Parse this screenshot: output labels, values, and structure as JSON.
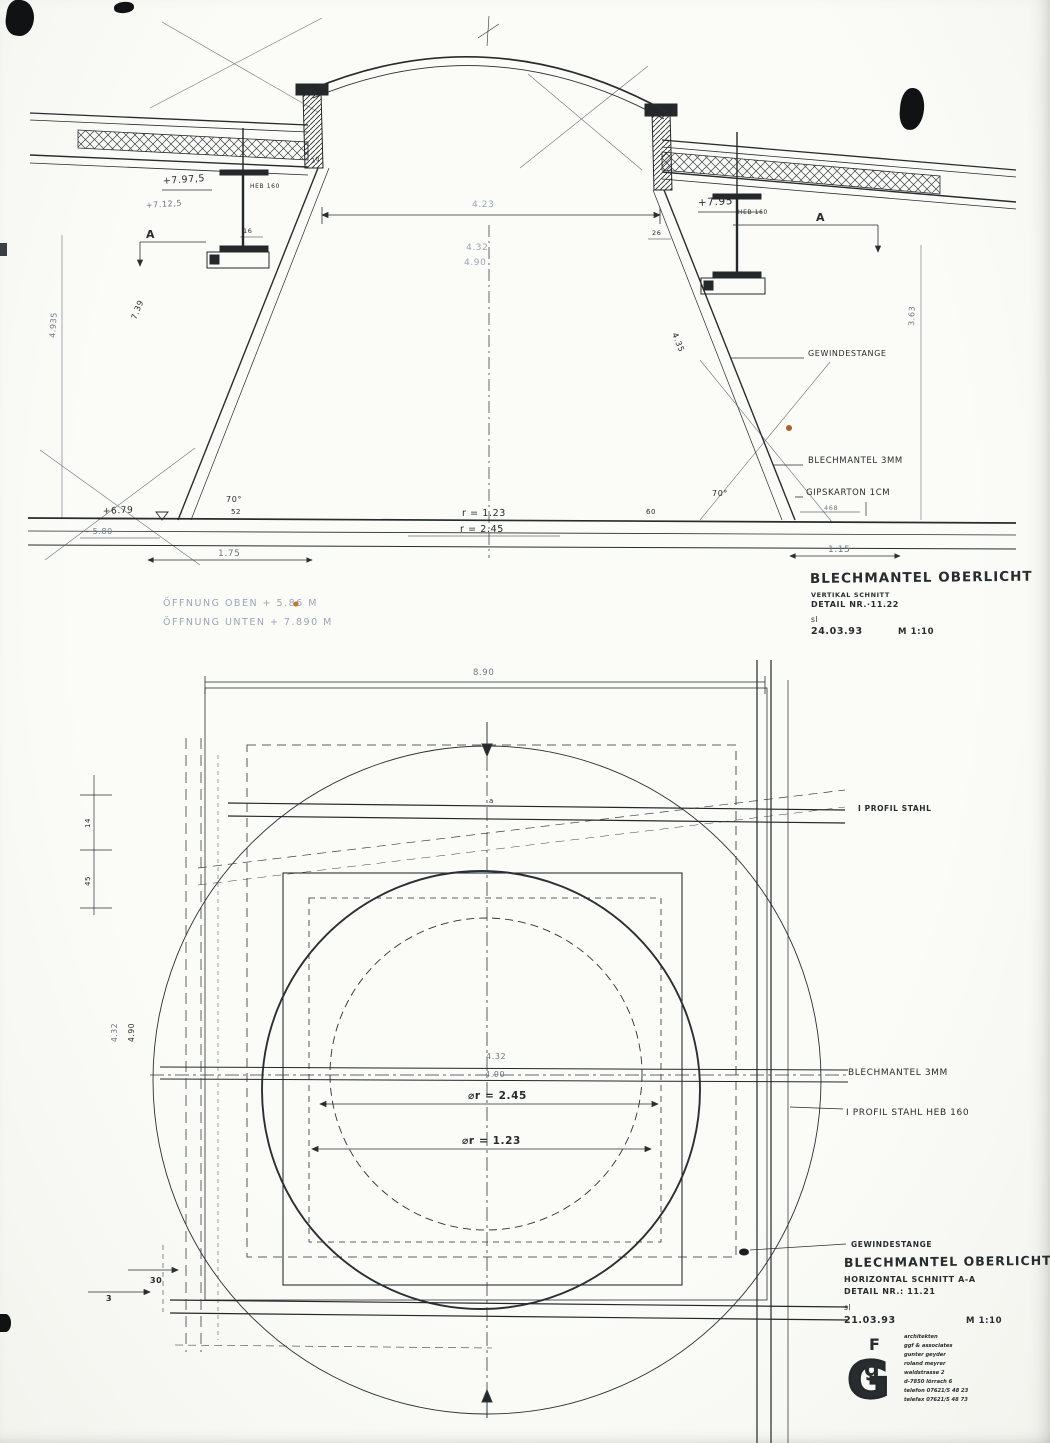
{
  "page": {
    "ink": "#272c2e",
    "faded_blue": "#9aa6b4",
    "paper": "#fbfbf8",
    "accent_speck": "#c07a32"
  },
  "section": {
    "title": {
      "name": "BLECHMANTEL  OBERLICHT",
      "subtitle": "VERTIKAL SCHNITT",
      "detail": "DETAIL NR.·11.22",
      "initials": "sl",
      "date": "24.03.93",
      "scale": "M 1:10"
    },
    "notes": {
      "line1": "ÖFFNUNG OBEN  + 5.86 M",
      "line2": "ÖFFNUNG UNTEN +  7.890 M"
    },
    "callouts": {
      "gewindestange": "GEWINDESTANGE",
      "blechmantel": "BLECHMANTEL  3MM",
      "gipskarton": "GIPSKARTON  1CM",
      "heb_left": "HEB 160",
      "heb_right": "HEB 160"
    },
    "levels": {
      "left_top": "+7.97,5",
      "left_mid": "+7.12,5",
      "right": "+7.95",
      "base": "+6.79",
      "base_under": "- 5.80"
    },
    "dims": {
      "top_width": "4.23",
      "mid_w1": "4.32",
      "mid_w2": "4.90",
      "r_top": "r = 1.23",
      "r_bottom": "r = 2.45",
      "angle_left": "70°",
      "angle_right": "70°",
      "bottom_left": "1.75",
      "bottom_right": "1.15",
      "tick_left": "52",
      "tick_right": "60",
      "jamb_left": "16",
      "jamb_right": "26",
      "curb_top": "20",
      "diag_left_outer": "4.935",
      "diag_left_inner": "7.39",
      "diag_right_inner": "4.35",
      "diag_right_outer": "3.63",
      "right_edge": "468"
    },
    "markers": {
      "a_left": "A",
      "a_right": "A"
    }
  },
  "plan": {
    "title": {
      "name": "BLECHMANTEL  OBERLICHT",
      "subtitle": "HORIZONTAL SCHNITT  A-A",
      "detail": "DETAIL NR.: 11.21",
      "initials": "sl",
      "date": "21.03.93",
      "scale": "M 1:10"
    },
    "callouts": {
      "i_profil": "I PROFIL STAHL",
      "blechmantel": "BLECHMANTEL   3MM",
      "i_profil_heb": "I PROFIL STAHL  HEB 160",
      "gewindestange": "GEWINDESTANGE"
    },
    "dims": {
      "overall": "8.90",
      "w1": "4.32",
      "w2": "4.90",
      "dia1": "⌀r = 2.45",
      "dia2": "⌀r = 1.23",
      "v1": "4.90",
      "v2": "4.32",
      "s1": "14",
      "s2": "45",
      "s3": "30",
      "s4": "3",
      "marker_a": "a"
    },
    "stamp": {
      "m1": "G",
      "m2": "g",
      "m3": "F",
      "lines": [
        "architekten",
        "ggf & associates",
        "gunter geyder",
        "roland meyrer",
        "waldstrasse 2",
        "d-7850 lörrach 6",
        "telefon 07621/5 48 23",
        "telefax 07621/5 48 73"
      ]
    }
  }
}
